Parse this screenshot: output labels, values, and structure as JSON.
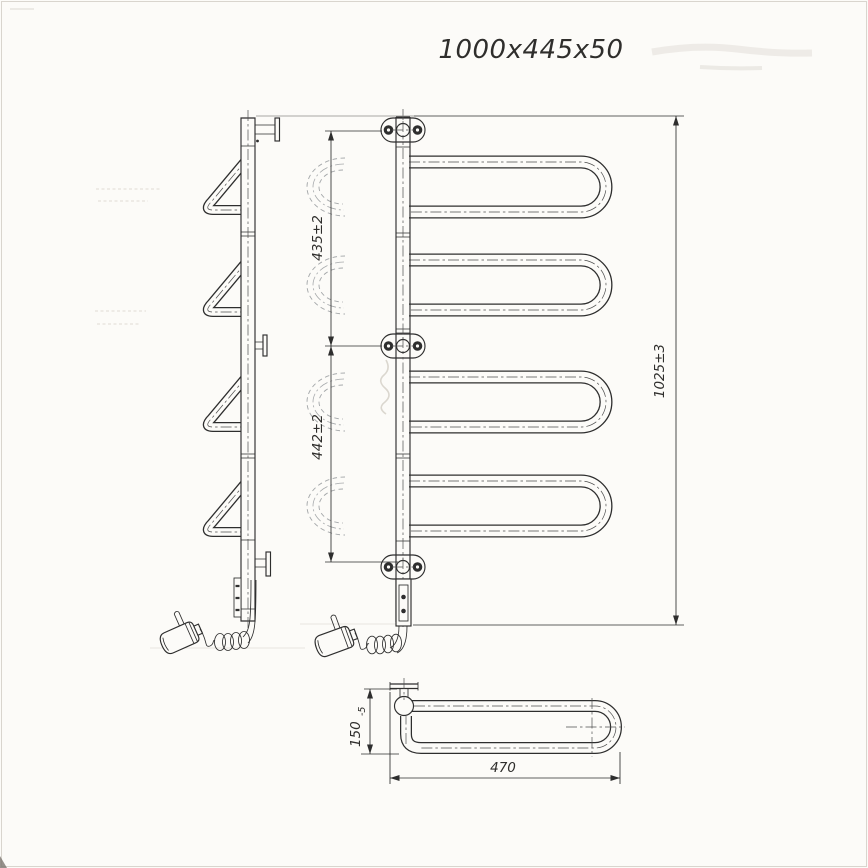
{
  "title": "1000x445x50",
  "dimensions": {
    "upper_span": "435±2",
    "lower_span": "442±2",
    "overall_height": "1025±3",
    "depth": "150",
    "depth_tolerance": "-5",
    "length": "470"
  },
  "colors": {
    "ink": "#2e2e2e",
    "paper": "#fcfbf8",
    "phantom": "#a6a9ab"
  }
}
